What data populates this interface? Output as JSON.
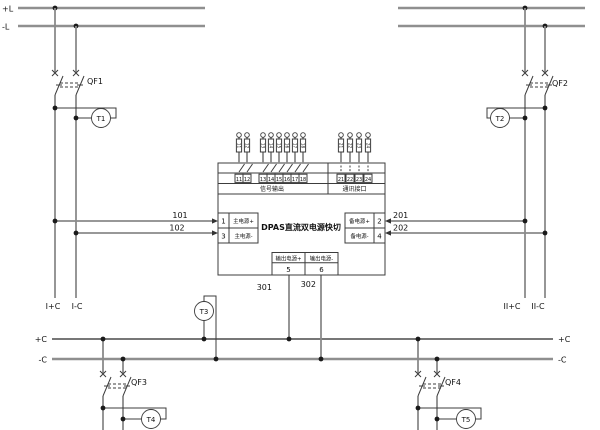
{
  "labels": {
    "bus_plus_l": "+L",
    "bus_minus_l": "-L",
    "bus_plus_c": "+C",
    "bus_minus_c": "-C",
    "qf1": "QF1",
    "qf2": "QF2",
    "qf3": "QF3",
    "qf4": "QF4",
    "t1": "T1",
    "t2": "T2",
    "t3": "T3",
    "t4": "T4",
    "t5": "T5",
    "w101": "101",
    "w102": "102",
    "w201": "201",
    "w202": "202",
    "w301": "301",
    "w302": "302",
    "feeder_i_plus": "I+C",
    "feeder_i_minus": "I-C",
    "feeder_ii_plus": "II+C",
    "feeder_ii_minus": "II-C"
  },
  "module": {
    "title": "DPAS直流双电源快切",
    "signal_caption": "信号输出",
    "comm_caption": "通讯接口",
    "main_plus_num": "1",
    "main_plus_label": "主电源+",
    "main_minus_num": "3",
    "main_minus_label": "主电源-",
    "backup_plus_num": "2",
    "backup_plus_label": "备电源+",
    "backup_minus_num": "4",
    "backup_minus_label": "备电源-",
    "out_plus_num": "5",
    "out_plus_label": "输出电源+",
    "out_minus_num": "6",
    "out_minus_label": "输出电源-",
    "signal_terminals": [
      "11",
      "12",
      "13",
      "14",
      "15",
      "16",
      "17",
      "18"
    ],
    "comm_terminals": [
      "21",
      "22",
      "23",
      "24"
    ]
  }
}
